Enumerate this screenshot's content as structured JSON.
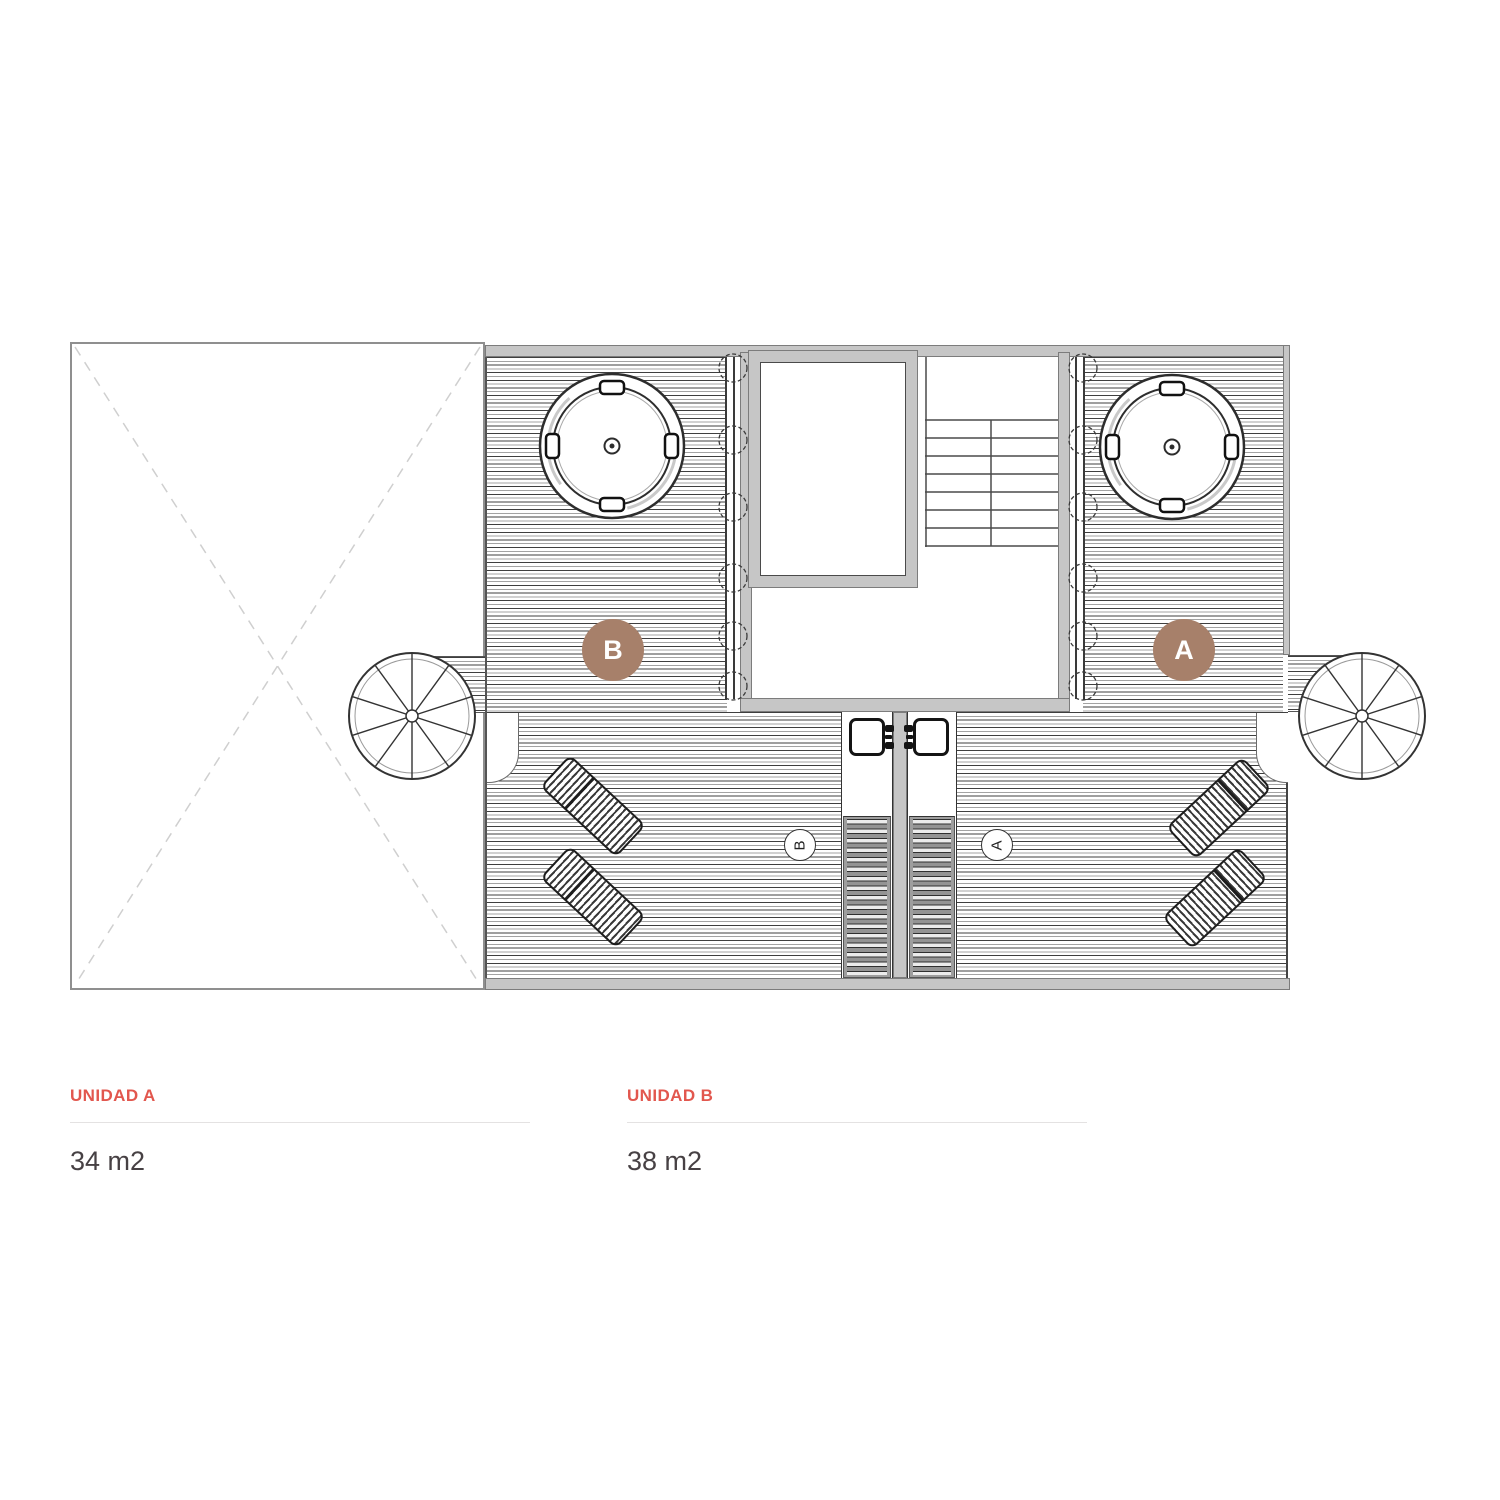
{
  "theme": {
    "accent": "#e2574e",
    "badge": "#a7806a",
    "wall": "#c6c6c6",
    "divider": "#e4e2e2",
    "area_text": "#474144",
    "roof_dash": "#cfcfcf"
  },
  "plan": {
    "badges": {
      "left": "B",
      "right": "A"
    },
    "markers": {
      "left": "B",
      "right": "A"
    }
  },
  "units": [
    {
      "name": "UNIDAD A",
      "area": "34 m2"
    },
    {
      "name": "UNIDAD B",
      "area": "38 m2"
    }
  ]
}
